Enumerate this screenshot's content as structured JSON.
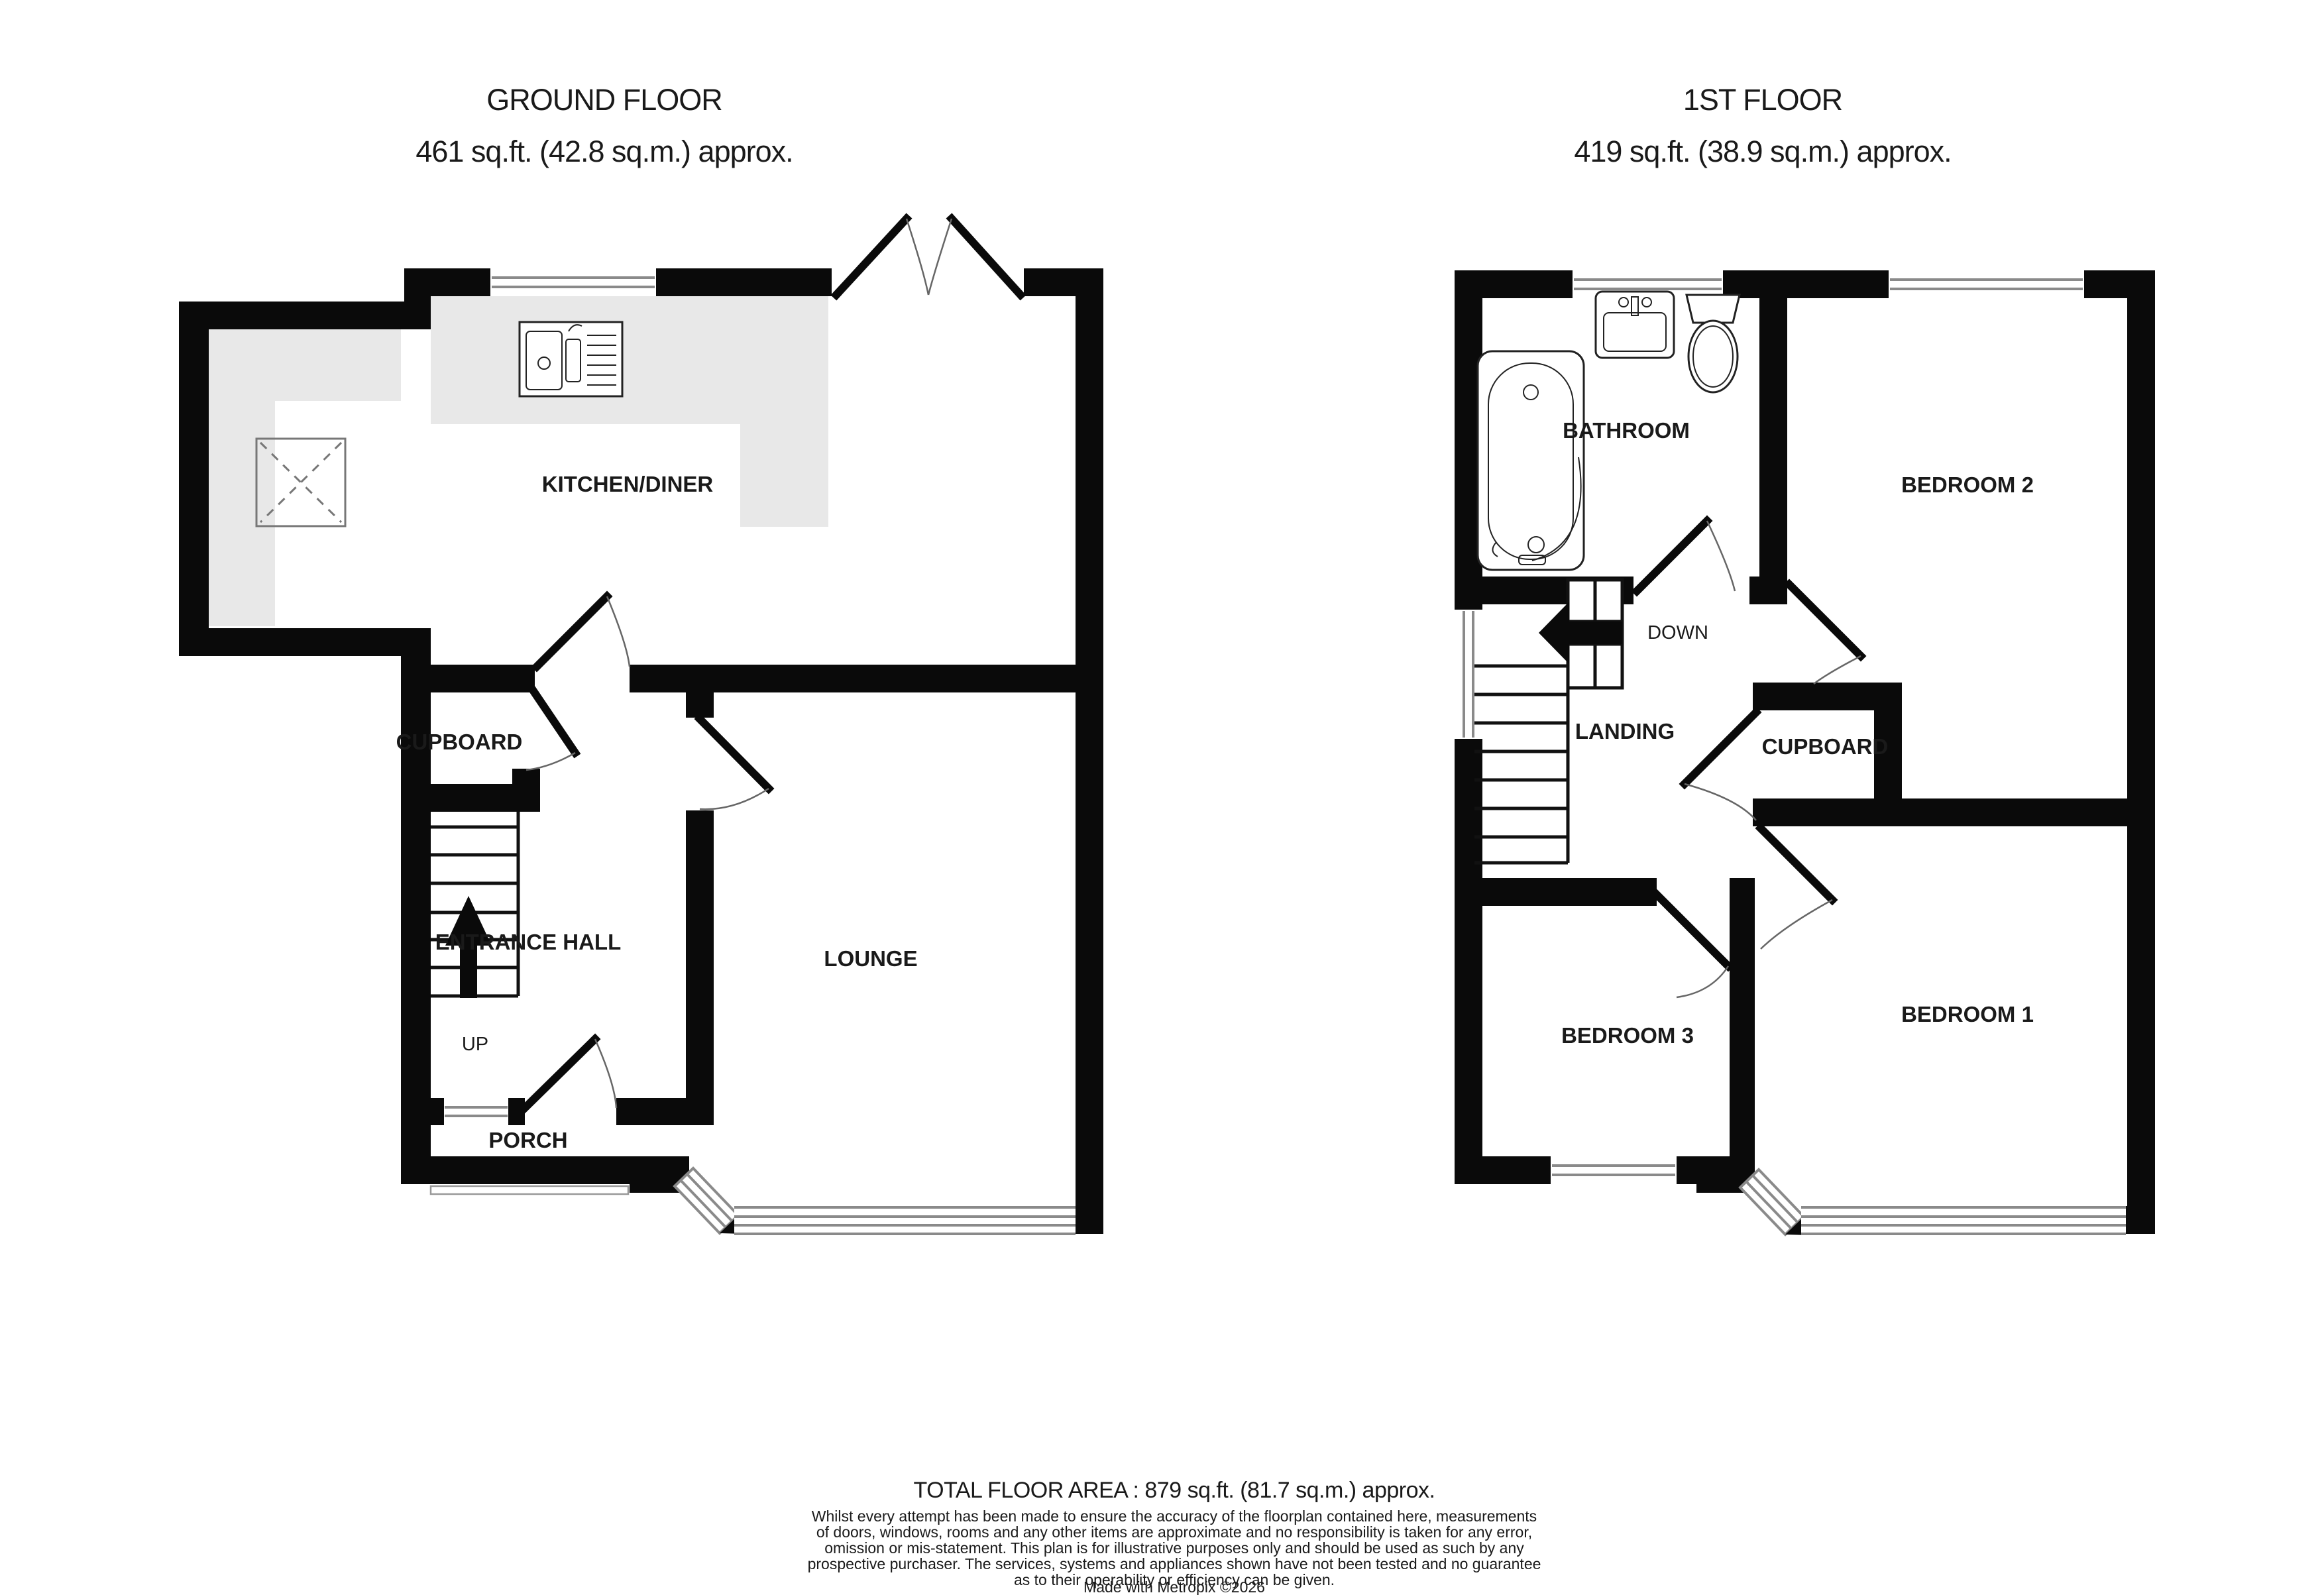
{
  "ground_floor": {
    "title": "GROUND FLOOR",
    "subtitle": "461 sq.ft. (42.8 sq.m.) approx.",
    "rooms": [
      {
        "label": "KITCHEN/DINER"
      },
      {
        "label": "CUPBOARD"
      },
      {
        "label": "ENTRANCE HALL"
      },
      {
        "label": "LOUNGE"
      },
      {
        "label": "PORCH"
      }
    ],
    "stair_direction_label": "UP"
  },
  "first_floor": {
    "title": "1ST FLOOR",
    "subtitle": "419 sq.ft. (38.9 sq.m.) approx.",
    "rooms": [
      {
        "label": "BATHROOM"
      },
      {
        "label": "BEDROOM 2"
      },
      {
        "label": "LANDING"
      },
      {
        "label": "CUPBOARD"
      },
      {
        "label": "BEDROOM 3"
      },
      {
        "label": "BEDROOM 1"
      }
    ],
    "stair_direction_label": "DOWN"
  },
  "footer": {
    "total_area": "TOTAL FLOOR AREA : 879 sq.ft. (81.7 sq.m.) approx.",
    "disclaimer_lines": [
      "Whilst every attempt has been made to ensure the accuracy of the floorplan contained here, measurements",
      "of doors, windows, rooms and any other items are approximate and no responsibility is taken for any error,",
      "omission or mis-statement. This plan is for illustrative purposes only and should be used as such by any",
      "prospective purchaser. The services, systems and appliances shown have not been tested and no guarantee",
      "as to their operability or efficiency can be given."
    ],
    "credit": "Made with Metropix ©2026"
  },
  "colors": {
    "wall": "#0a0a0a",
    "counter": "#e8e8e8",
    "window_line": "#8a8a8a",
    "door_arc": "#666666",
    "text": "#1a1a1a"
  }
}
